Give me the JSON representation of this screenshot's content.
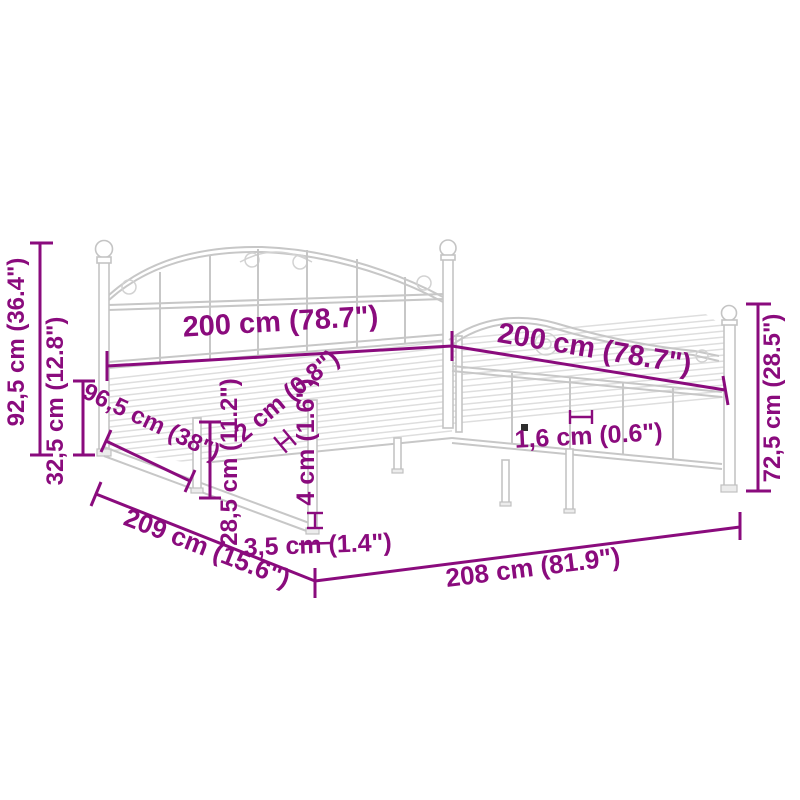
{
  "diagram": {
    "type": "product-dimension-diagram",
    "subject": "metal-bed-frame",
    "accent_color": "#8A0B7D",
    "line_art_color": "#c7c7c7",
    "labels": {
      "headboard_height": "92,5 cm (36.4\")",
      "base_height": "32,5 cm (12.8\")",
      "side_panel_length": "96,5 cm (38\")",
      "headboard_width": "200 cm (78.7\")",
      "side_rail_length": "200 cm (78.7\")",
      "footboard_height": "72,5 cm (28.5\")",
      "under_bed_clearance": "28,5 cm (11.2\")",
      "slat_thickness": "2 cm (0.8\")",
      "foot_height": "4 cm (1.6\")",
      "slat_bar_thickness": "1,6 cm (0.6\")",
      "frame_width_floor": "209 cm (15.6\")",
      "frame_length_floor": "208 cm (81.9\")",
      "leg_width": "3,5 cm (1.4\")"
    }
  }
}
